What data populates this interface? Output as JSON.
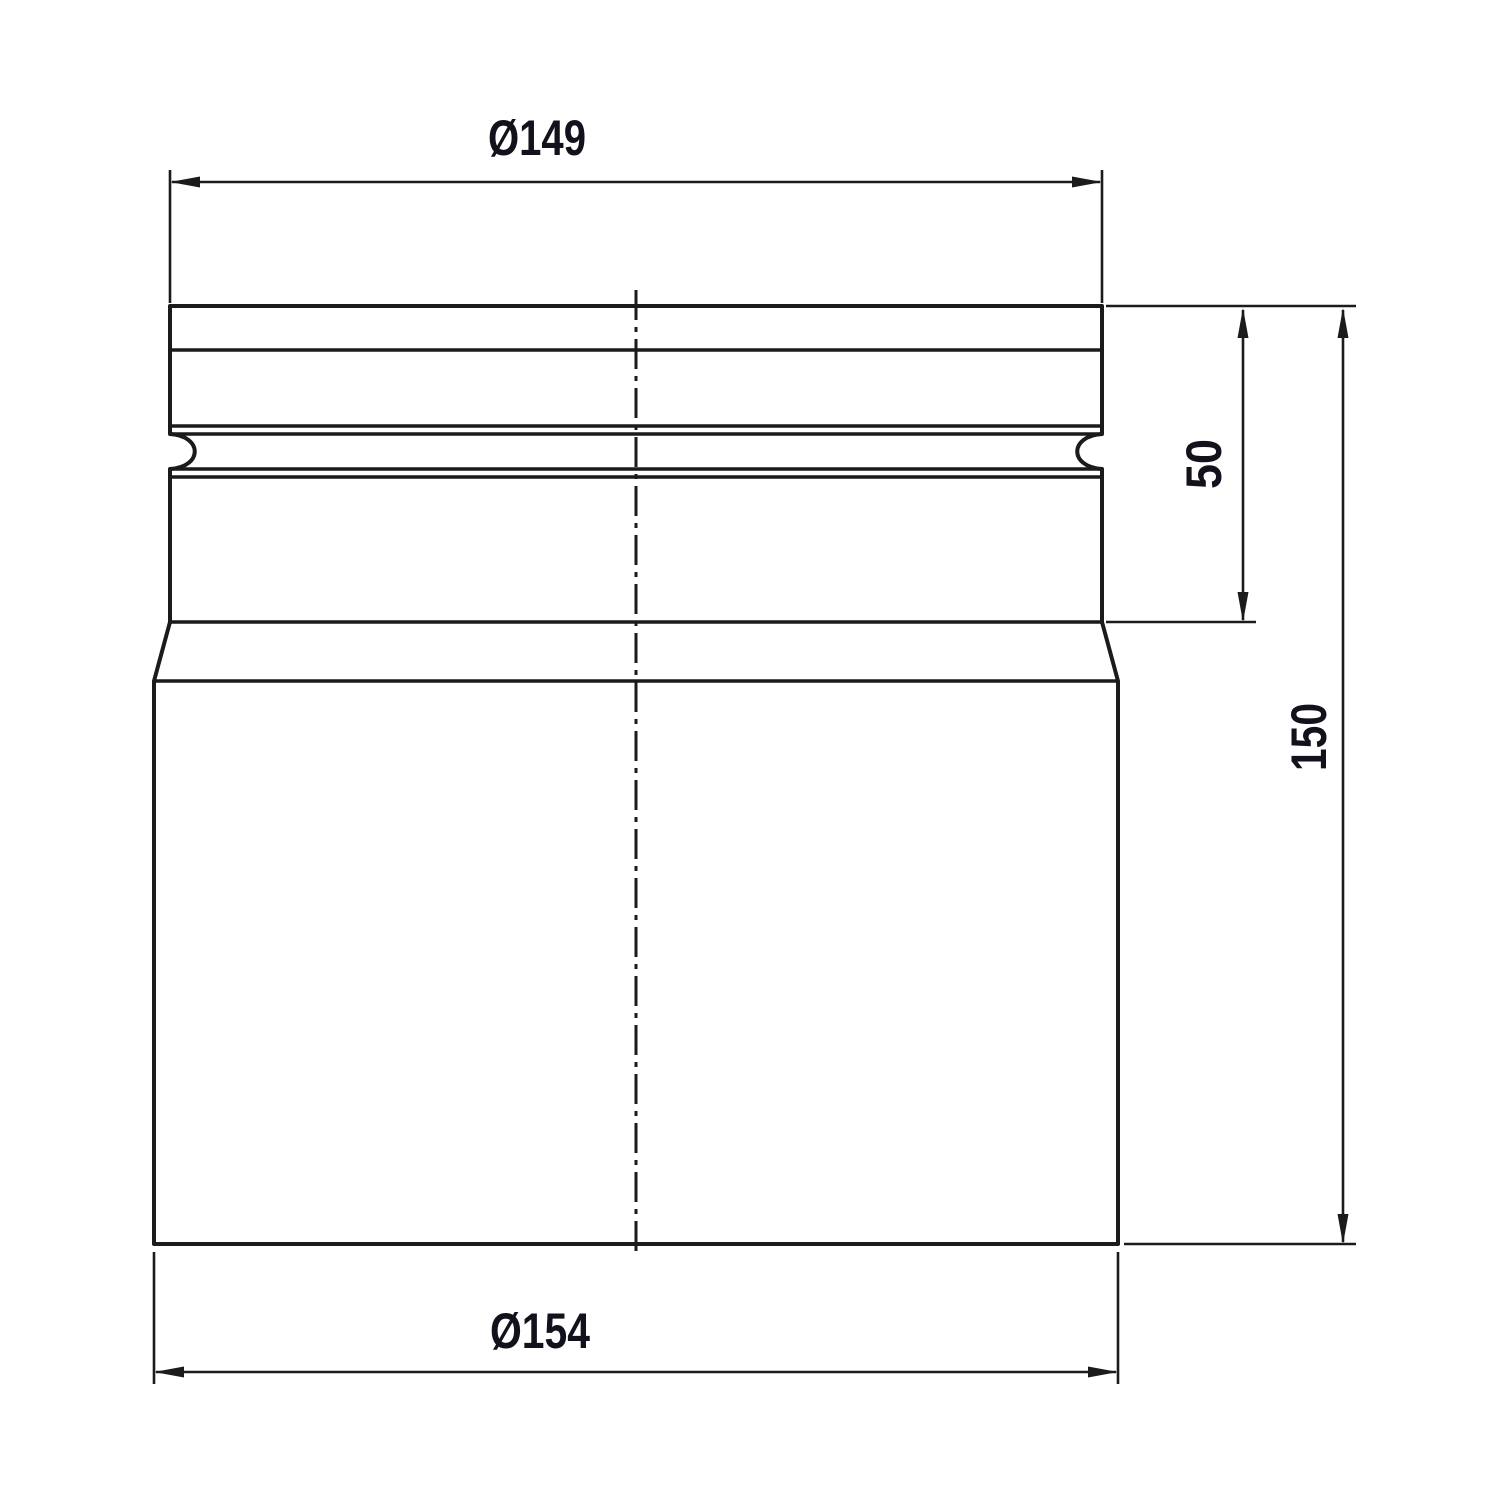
{
  "drawing": {
    "colors": {
      "background": "#ffffff",
      "lines": "#1b1b1b",
      "text": "#12121c"
    },
    "dimensions": {
      "top_diameter": {
        "label": "Ø149"
      },
      "bottom_diameter": {
        "label": "Ø154"
      },
      "collar_height": {
        "label": "50"
      },
      "overall_height": {
        "label": "150"
      }
    }
  }
}
